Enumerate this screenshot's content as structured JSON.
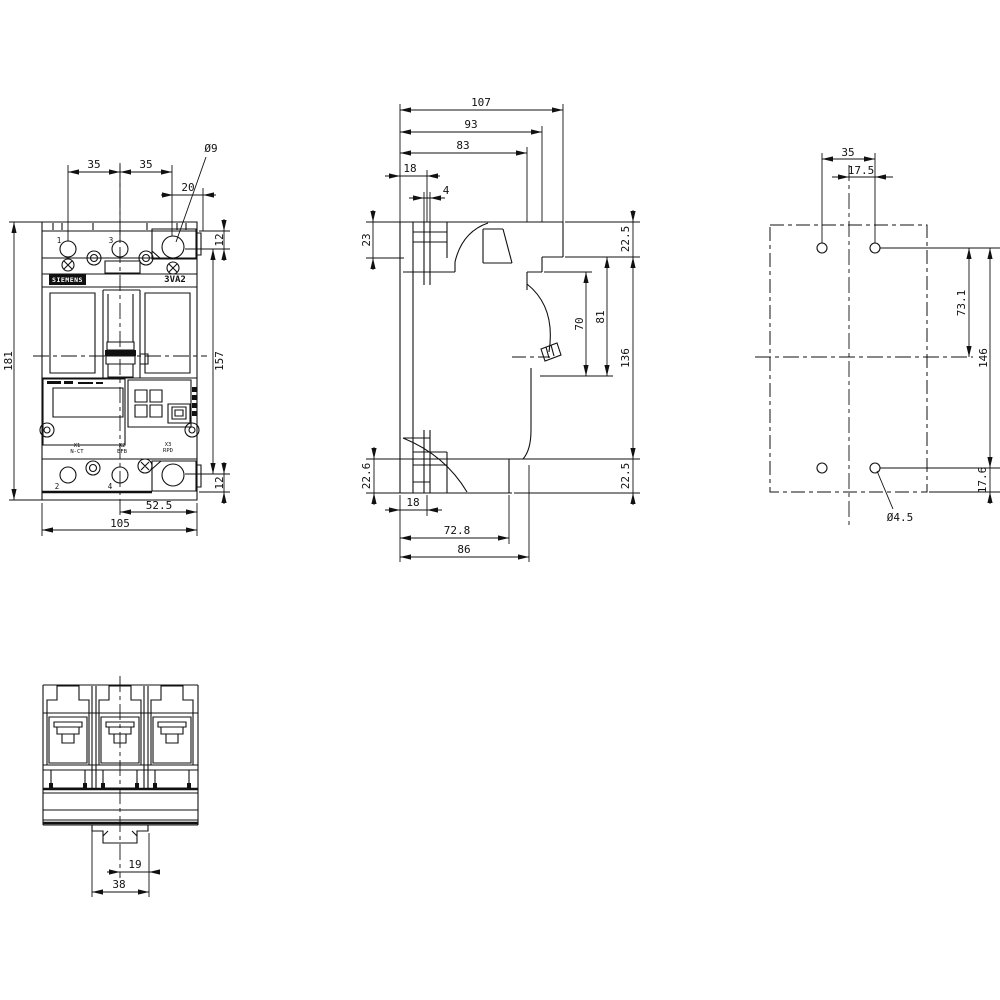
{
  "front_view": {
    "dim_35_left": "35",
    "dim_35_right": "35",
    "dim_20": "20",
    "dia_9": "Ø9",
    "dim_12_top": "12",
    "dim_157": "157",
    "dim_12_bottom": "12",
    "dim_181": "181",
    "dim_52_5": "52.5",
    "dim_105": "105",
    "brand": "SIEMENS",
    "model": "3VA2",
    "pole_1": "1",
    "pole_3": "3",
    "pole_2": "2",
    "pole_4": "4",
    "x1": "X1",
    "x1_sub": "N-CT",
    "x2": "X2",
    "x2_sub": "EFB",
    "x3": "X3",
    "x3_sub": "RPD"
  },
  "side_view": {
    "dim_107": "107",
    "dim_93": "93",
    "dim_83": "83",
    "dim_18_top": "18",
    "dim_4": "4",
    "dim_23": "23",
    "dim_22_5_top": "22.5",
    "dim_81": "81",
    "dim_70": "70",
    "dim_136": "136",
    "dim_22_5_bottom": "22.5",
    "dim_22_6": "22.6",
    "dim_18_bottom": "18",
    "dim_72_8": "72.8",
    "dim_86": "86"
  },
  "drill_plan": {
    "dim_35": "35",
    "dim_17_5": "17.5",
    "dim_73_1": "73.1",
    "dim_146": "146",
    "dim_17_6": "17.6",
    "dia_4_5": "Ø4.5"
  },
  "bottom_view": {
    "dim_19": "19",
    "dim_38": "38"
  }
}
